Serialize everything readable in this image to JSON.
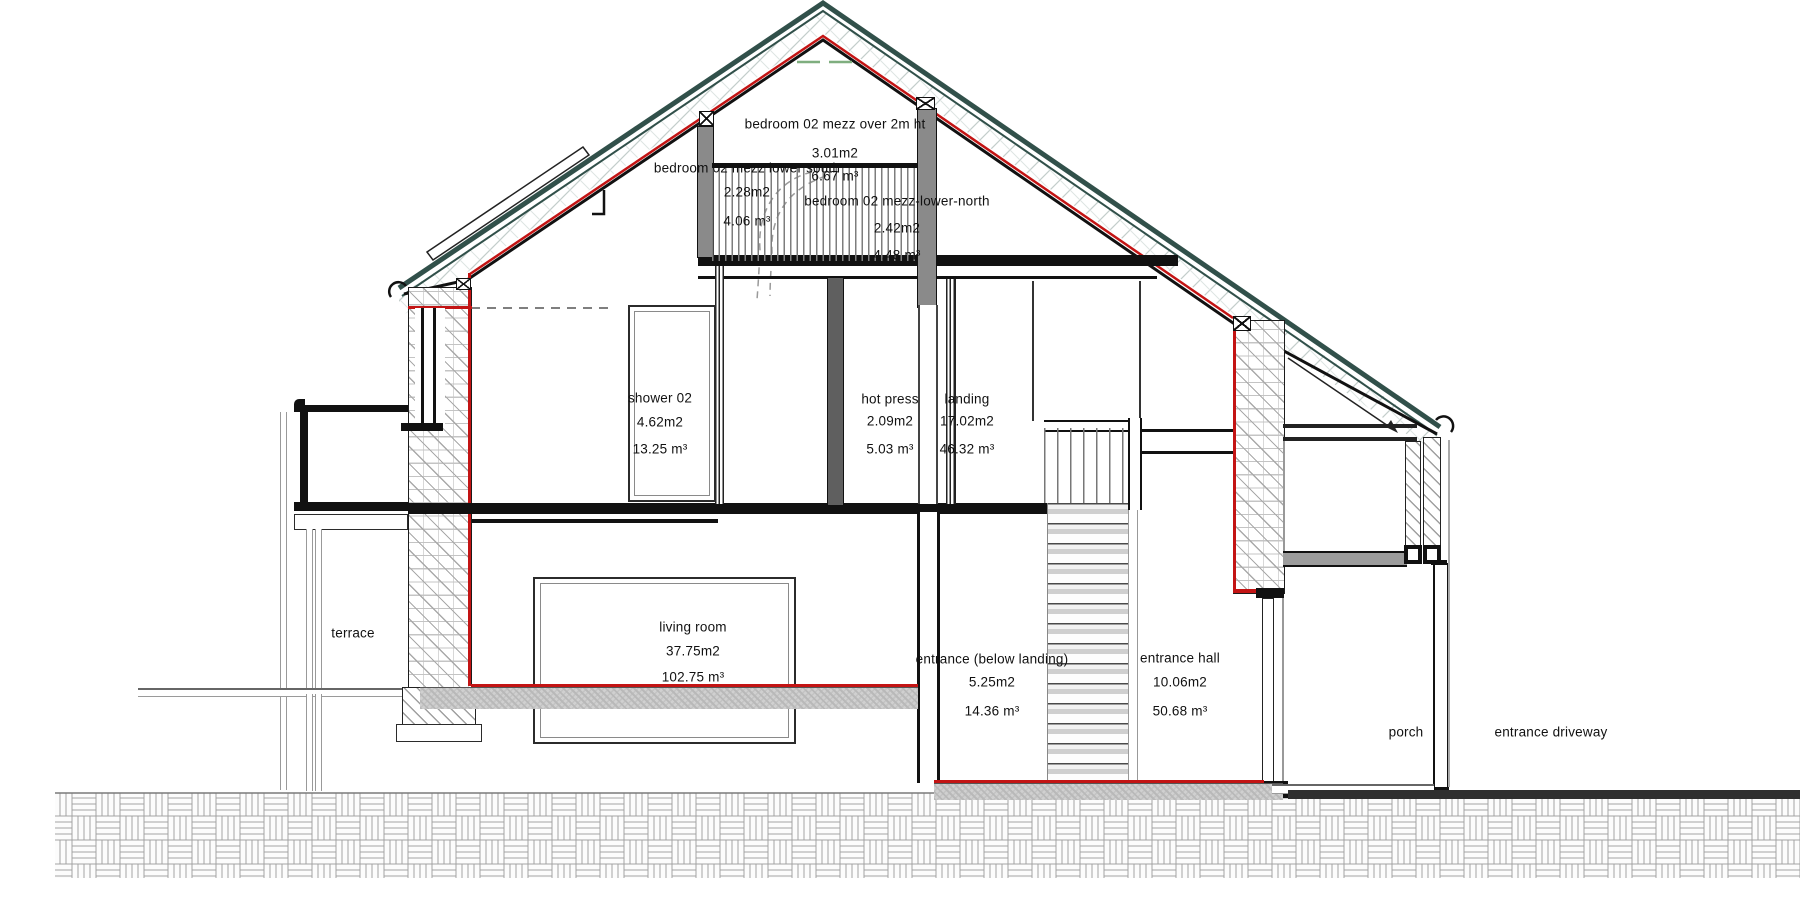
{
  "drawing": {
    "kind": "house cross-section",
    "rooms": [
      {
        "name": "bedroom 02 mezz over 2m ht",
        "area": "3.01m2",
        "volume": "6.67 m³",
        "cx": 835,
        "ny": 124,
        "ay": 153,
        "vy": 176
      },
      {
        "name": "bedroom 02 mezz lower south",
        "area": "2.28m2",
        "volume": "4.06 m³",
        "cx": 747,
        "ny": 168,
        "ay": 192,
        "vy": 221
      },
      {
        "name": "bedroom 02 mezz-lower-north",
        "area": "2.42m2",
        "volume": "4.48 m³",
        "cx": 897,
        "ny": 201,
        "ay": 228,
        "vy": 255
      },
      {
        "name": "shower 02",
        "area": "4.62m2",
        "volume": "13.25 m³",
        "cx": 660,
        "ny": 398,
        "ay": 422,
        "vy": 449
      },
      {
        "name": "hot press",
        "area": "2.09m2",
        "volume": "5.03 m³",
        "cx": 890,
        "ny": 399,
        "ay": 421,
        "vy": 449
      },
      {
        "name": "landing",
        "area": "17.02m2",
        "volume": "46.32 m³",
        "cx": 967,
        "ny": 399,
        "ay": 421,
        "vy": 449
      },
      {
        "name": "living room",
        "area": "37.75m2",
        "volume": "102.75 m³",
        "cx": 693,
        "ny": 627,
        "ay": 651,
        "vy": 677
      },
      {
        "name": "entrance (below landing)",
        "area": "5.25m2",
        "volume": "14.36 m³",
        "cx": 992,
        "ny": 659,
        "ay": 682,
        "vy": 711
      },
      {
        "name": "entrance hall",
        "area": "10.06m2",
        "volume": "50.68 m³",
        "cx": 1180,
        "ny": 658,
        "ay": 682,
        "vy": 711
      }
    ],
    "zones": [
      {
        "name": "terrace",
        "cx": 353,
        "cy": 633
      },
      {
        "name": "porch",
        "cx": 1406,
        "cy": 732
      },
      {
        "name": "entrance driveway",
        "cx": 1551,
        "cy": 732
      }
    ],
    "colors": {
      "section_line_red": "#c31414",
      "roof_outer_teal": "#31504a",
      "post_gray": "#8a8a8a",
      "slab_gray": "#9c9c9c",
      "text": "#111111"
    }
  }
}
